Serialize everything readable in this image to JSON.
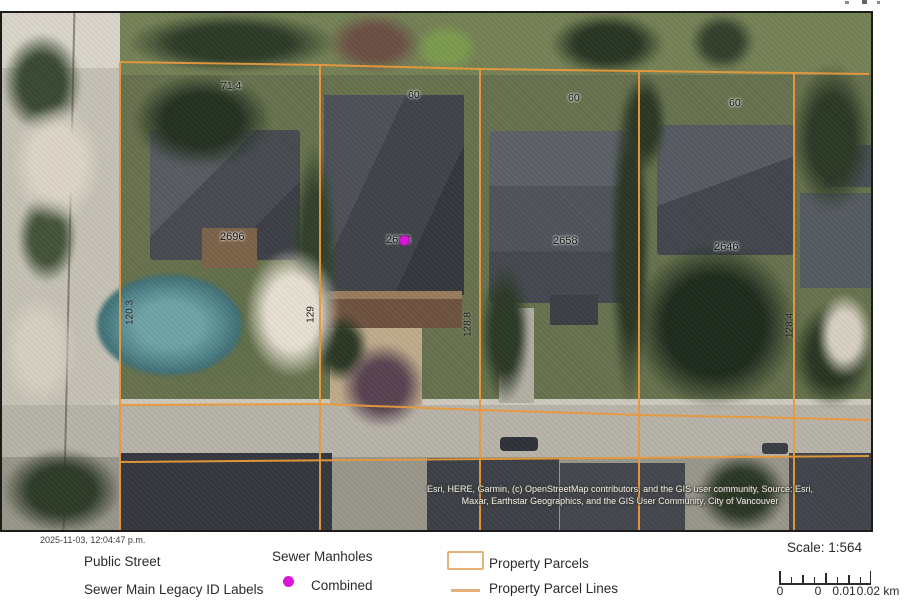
{
  "map": {
    "parcel_id_labels": [
      {
        "text": "2696"
      },
      {
        "text": "2676"
      },
      {
        "text": "2658"
      },
      {
        "text": "2646"
      }
    ],
    "frontage_labels": [
      {
        "text": "71.4"
      },
      {
        "text": "60"
      },
      {
        "text": "60"
      },
      {
        "text": "60"
      }
    ],
    "depth_labels": [
      {
        "text": "120.3"
      },
      {
        "text": "129"
      },
      {
        "text": "128.8"
      },
      {
        "text": "128.4"
      }
    ],
    "attribution_line1": "Esri, HERE, Garmin, (c) OpenStreetMap contributors, and the GIS user community, Source: Esri,",
    "attribution_line2": "Maxar, Earthstar Geographics, and the GIS User Community, City of Vancouver",
    "manhole_type": "Combined"
  },
  "footer": {
    "timestamp": "2025-11-03, 12:04:47 p.m.",
    "legend": {
      "public_street": "Public Street",
      "sewer_main_legacy": "Sewer Main Legacy ID Labels",
      "sewer_manholes": "Sewer Manholes",
      "combined": "Combined",
      "property_parcels": "Property Parcels",
      "property_parcel_lines": "Property Parcel Lines"
    },
    "scale": {
      "label": "Scale: 1:564",
      "bar_labels": [
        "0",
        "0",
        "0.01",
        "0.02 km"
      ]
    }
  },
  "colors": {
    "parcel_line": "#E8993C",
    "legend_swatch": "#E5B27A",
    "manhole_magenta": "#D718D7"
  }
}
